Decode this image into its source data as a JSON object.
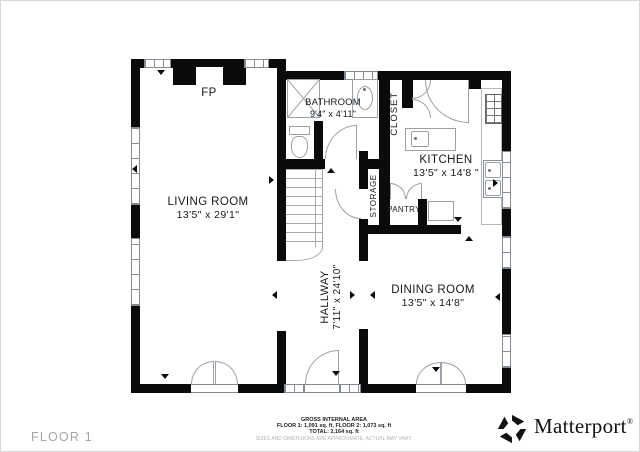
{
  "floor_label": "FLOOR 1",
  "rooms": {
    "living_room": {
      "name": "LIVING ROOM",
      "dims": "13'5\" x 29'1\""
    },
    "fireplace": {
      "abbr": "FP"
    },
    "bathroom": {
      "name": "BATHROOM",
      "dims": "9'4\" x 4'11\""
    },
    "closet": {
      "name": "CLOSET"
    },
    "kitchen": {
      "name": "KITCHEN",
      "dims": "13'5\" x 14'8 \""
    },
    "storage": {
      "name": "STORAGE"
    },
    "pantry": {
      "name": "PANTRY"
    },
    "hallway": {
      "name": "HALLWAY",
      "dims": "7'11\" x 24'10\""
    },
    "dining_room": {
      "name": "DINING ROOM",
      "dims": "13'5\" x 14'8\""
    }
  },
  "footer": {
    "area_title": "GROSS INTERNAL AREA",
    "floors_line": "FLOOR 1: 1,091 sq. ft, FLOOR 2: 1,073 sq. ft",
    "total_line": "TOTAL: 2,164 sq. ft",
    "disclaimer": "SIZES AND DIMENSIONS ARE APPROXIMATE, ACTUAL MAY VARY."
  },
  "brand": {
    "name": "Matterport",
    "mark": "®"
  },
  "icons": {
    "logo": "matterport-pinwheel-icon"
  },
  "colors": {
    "wall": "#0b0b0b",
    "line": "#858b93",
    "text": "#17191c",
    "muted": "#b3b3b3"
  }
}
